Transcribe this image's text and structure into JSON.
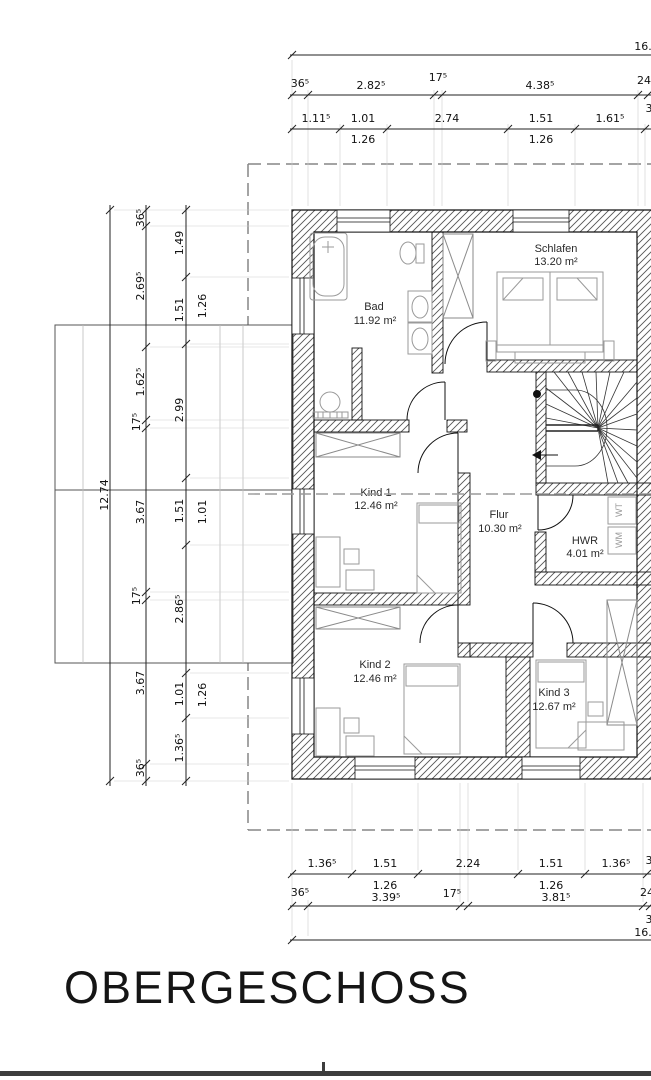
{
  "title": "OBERGESCHOSS",
  "rooms": {
    "bad": {
      "name": "Bad",
      "area": "11.92 m²"
    },
    "schlafen": {
      "name": "Schlafen",
      "area": "13.20 m²"
    },
    "kind1": {
      "name": "Kind 1",
      "area": "12.46 m²"
    },
    "flur": {
      "name": "Flur",
      "area": "10.30 m²"
    },
    "hwr": {
      "name": "HWR",
      "area": "4.01 m²"
    },
    "kind2": {
      "name": "Kind 2",
      "area": "12.46 m²"
    },
    "kind3": {
      "name": "Kind 3",
      "area": "12.67 m²"
    }
  },
  "appliances": {
    "wt": "WT",
    "wm": "WM"
  },
  "dims": {
    "top_total": "16.",
    "top_outer": [
      "36⁵",
      "2.82⁵",
      "17⁵",
      "4.38⁵",
      "24"
    ],
    "top_inner": [
      "1.11⁵",
      "1.01",
      "2.74",
      "1.51",
      "1.61⁵",
      "3"
    ],
    "top_inner_sub": [
      "1.26",
      "1.26"
    ],
    "left_total": "12.74",
    "left_outer": [
      "36⁵",
      "2.69⁵",
      "1.62⁵",
      "17⁵",
      "3.67",
      "17⁵",
      "3.67",
      "36⁵"
    ],
    "left_inner": [
      "1.49",
      "1.51",
      "2.99",
      "1.51",
      "2.86⁵",
      "1.01",
      "1.36⁵"
    ],
    "left_inner_sub": [
      "1.26",
      "1.01",
      "1.26"
    ],
    "bottom_inner": [
      "1.36⁵",
      "1.51",
      "2.24",
      "1.51",
      "1.36⁵",
      "3"
    ],
    "bottom_inner_sub": [
      "1.26",
      "1.26"
    ],
    "bottom_outer": [
      "36⁵",
      "3.39⁵",
      "17⁵",
      "3.81⁵",
      "24",
      "3"
    ],
    "bottom_total": "16."
  }
}
